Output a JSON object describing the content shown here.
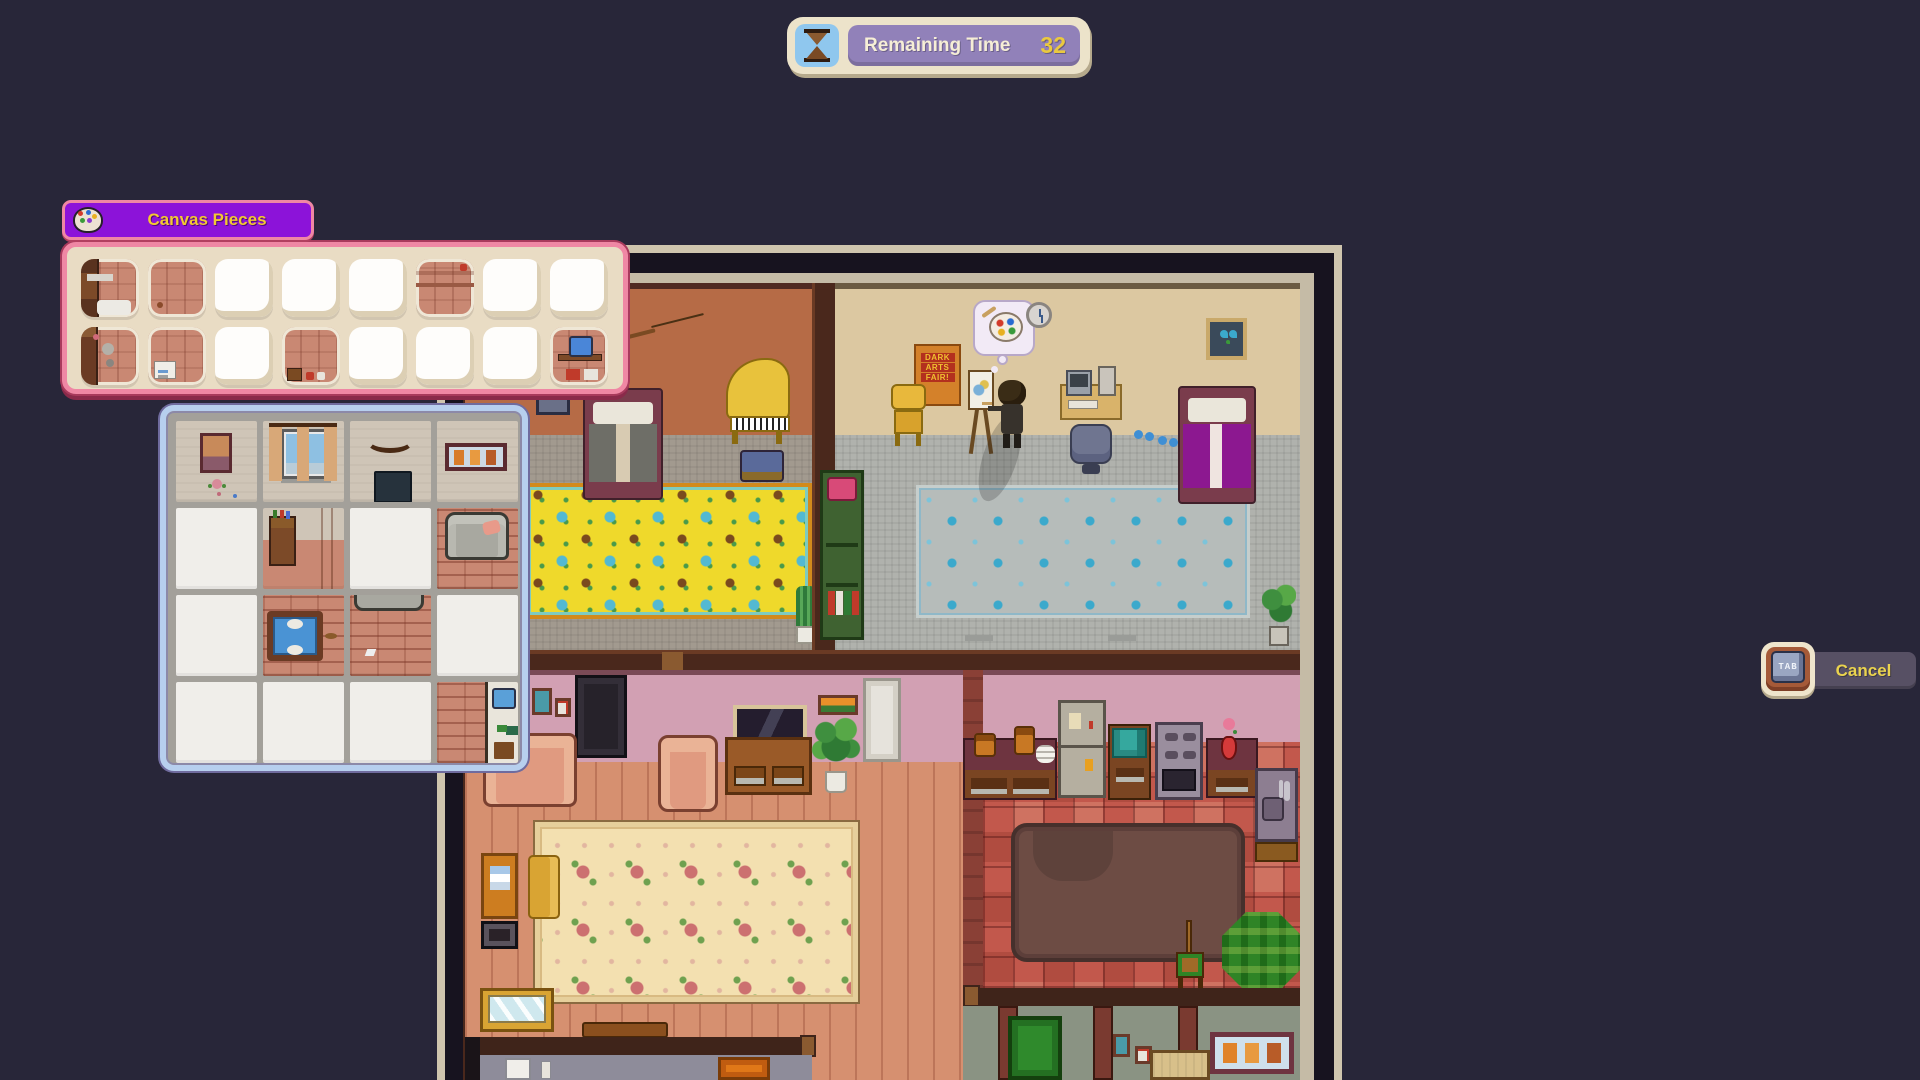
{
  "hud": {
    "remaining_time": {
      "label": "Remaining Time",
      "value": "32",
      "icon": "hourglass-icon",
      "panel_color": "#9181b9",
      "value_color": "#eac93f"
    },
    "cancel_button": {
      "key_hint": "TAB",
      "label": "Cancel",
      "label_color": "#ead34e"
    }
  },
  "canvas_pieces_panel": {
    "title": "Canvas Pieces",
    "title_color": "#f2c832",
    "header_bg": "#8c13d9",
    "border_color": "#ef87a4",
    "icon": "palette-icon",
    "tray": {
      "rows": 2,
      "cols": 8,
      "slots": [
        {
          "filled": true,
          "motif": "cabinet-floor"
        },
        {
          "filled": true,
          "motif": "floor-plain"
        },
        {
          "filled": false
        },
        {
          "filled": false
        },
        {
          "filled": false
        },
        {
          "filled": true,
          "motif": "floor-wall"
        },
        {
          "filled": false
        },
        {
          "filled": false
        },
        {
          "filled": true,
          "motif": "dresser"
        },
        {
          "filled": true,
          "motif": "floor-card"
        },
        {
          "filled": false
        },
        {
          "filled": true,
          "motif": "floor-items"
        },
        {
          "filled": false
        },
        {
          "filled": false
        },
        {
          "filled": false
        },
        {
          "filled": true,
          "motif": "desk-blue"
        }
      ]
    }
  },
  "puzzle_board": {
    "rows": 4,
    "cols": 4,
    "border_color": "#b7cfee",
    "cells": [
      {
        "filled": true,
        "motif": "picture-flower"
      },
      {
        "filled": true,
        "motif": "window-curtains"
      },
      {
        "filled": true,
        "motif": "bow-tv"
      },
      {
        "filled": true,
        "motif": "triple-frame"
      },
      {
        "filled": false
      },
      {
        "filled": true,
        "motif": "cabinet-door"
      },
      {
        "filled": false
      },
      {
        "filled": true,
        "motif": "couch"
      },
      {
        "filled": false
      },
      {
        "filled": true,
        "motif": "table-blue"
      },
      {
        "filled": true,
        "motif": "couch-floor"
      },
      {
        "filled": false
      },
      {
        "filled": false
      },
      {
        "filled": false
      },
      {
        "filled": false
      },
      {
        "filled": true,
        "motif": "sink-corner"
      }
    ]
  },
  "scene": {
    "poster": {
      "line1": "DARK",
      "line2": "ARTS",
      "line3": "FAIR!"
    },
    "rooms": [
      "bedroom-left",
      "bedroom-right",
      "living-room",
      "kitchen",
      "laundry-room",
      "mudroom"
    ]
  }
}
